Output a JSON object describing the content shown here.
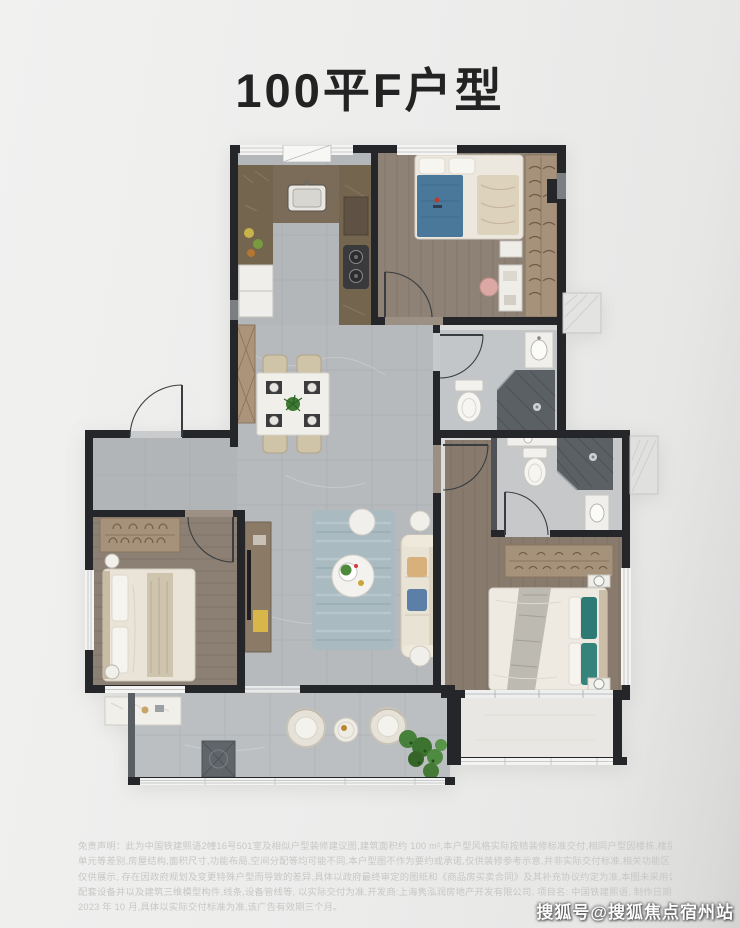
{
  "page": {
    "title": "100平F户型",
    "watermark": "搜狐号@搜狐焦点宿州站"
  },
  "disclaimer": {
    "lines": [
      "免责声明：此为中国铁建熙语2幢16号501室及相似户型装修建议图,建筑面积约 100 m²,本户型风格实际按精装修标准交付,相同户型因楼栋,楼层,",
      "单元等差别,房屋结构,面积尺寸,功能布局,空间分配等均可能不同,本户型图不作为要约或承诺,仅供装修参考示意,并非实际交付标准,相关功能区",
      "仅供展示, 存在因政府规划及变更特殊户型而导致的差异,具体以政府最终审定的图纸和《商品房买卖合同》及其补充协议约定为准,本图未采用公司",
      "配套设备并以及建筑三维模型构件,线条,设备管线等, 以实际交付为准,开发商:上海隽泓润房地产开发有限公司, 项目名: 中国铁建熙语, 制作日期",
      "2023 年 10 月,具体以实际交付标准为准,该广告有效期三个月。"
    ]
  },
  "colors": {
    "background": "#ececeb",
    "title_text": "#232323",
    "wall": "#24262a",
    "tile_floor": "#b7babd",
    "wood_floor": "#8e8276",
    "counter_brown": "#7b6b59",
    "wardrobe_tan": "#a6917a",
    "bed_blanket_blue": "#49789a",
    "pillow_teal": "#2e7a74",
    "rug_blue_gray": "#a9bac1",
    "shower_tile_dark": "#5b6065",
    "plant_green": "#47803a",
    "disclaimer_text": "#c7c7c5",
    "watermark_text": "#fcfcfc"
  }
}
